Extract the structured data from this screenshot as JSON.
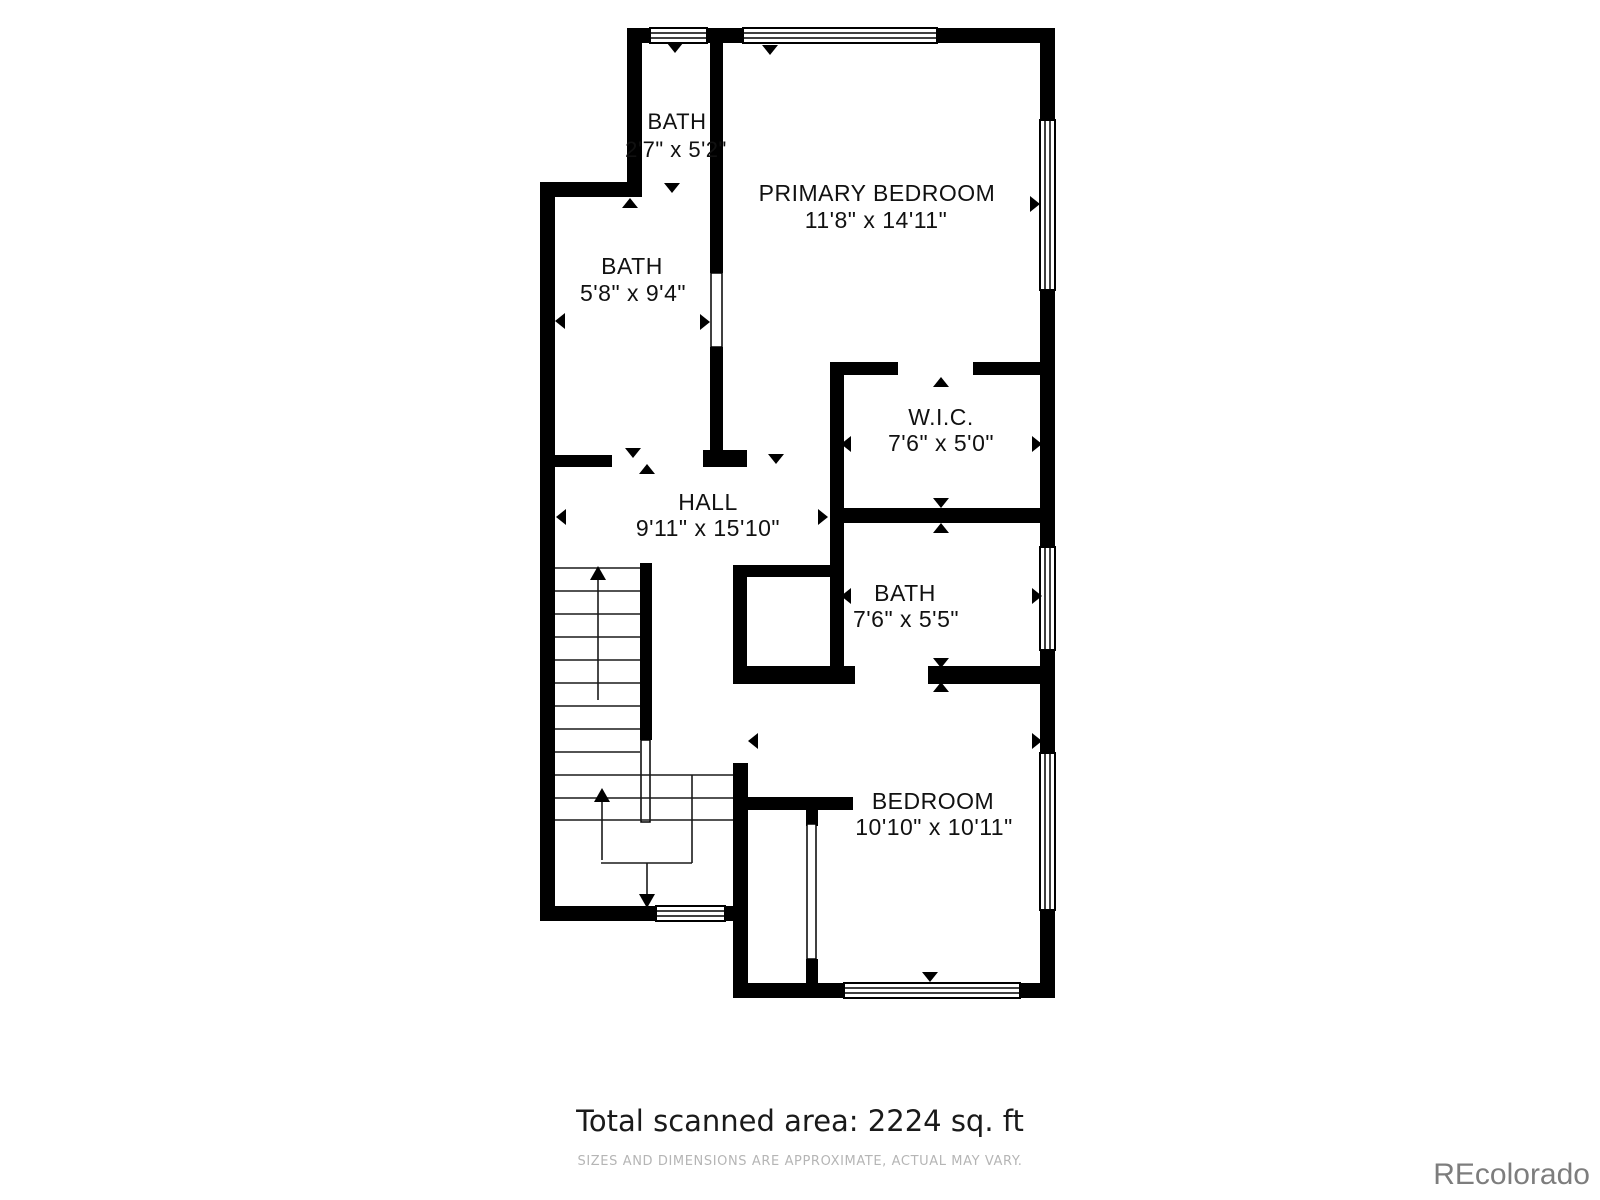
{
  "rooms": [
    {
      "name": "BATH",
      "dims": "2'7\" x 5'2\""
    },
    {
      "name": "PRIMARY BEDROOM",
      "dims": "11'8\" x 14'11\""
    },
    {
      "name": "BATH",
      "dims": "5'8\" x 9'4\""
    },
    {
      "name": "W.I.C.",
      "dims": "7'6\" x 5'0\""
    },
    {
      "name": "HALL",
      "dims": "9'11\" x 15'10\""
    },
    {
      "name": "BATH",
      "dims": "7'6\" x 5'5\""
    },
    {
      "name": "BEDROOM",
      "dims": "10'10\" x 10'11\""
    }
  ],
  "footer": {
    "total_area": "Total scanned area: 2224 sq. ft",
    "disclaimer": "SIZES AND DIMENSIONS ARE APPROXIMATE, ACTUAL MAY VARY.",
    "watermark": "REcolorado"
  },
  "colors": {
    "wall": "#000000",
    "background": "#ffffff",
    "disclaimer_text": "#b5b5b5",
    "watermark_text": "#7d7d7d"
  }
}
